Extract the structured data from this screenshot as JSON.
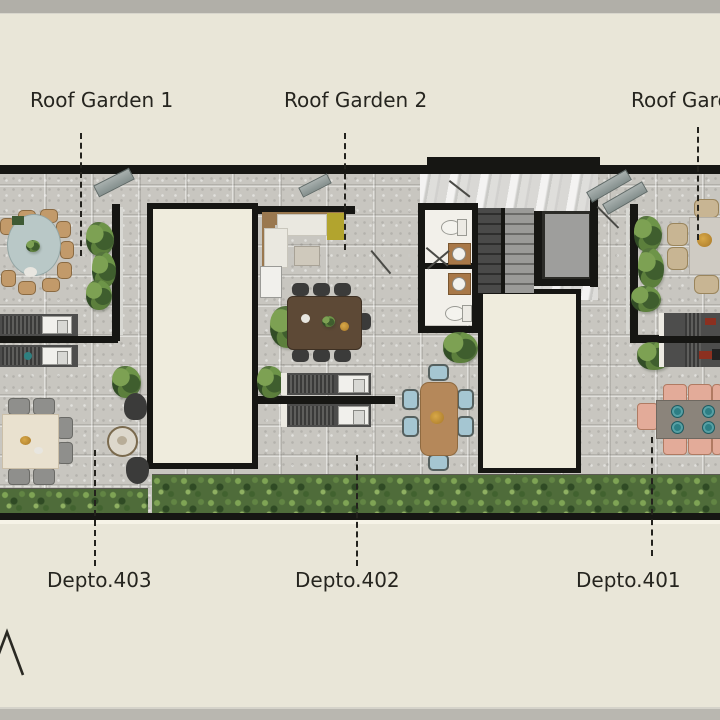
{
  "page": {
    "background_color": "#e9e6d8",
    "top_bar_color": "#b1afa8",
    "bottom_bar_color": "#b9b7b0"
  },
  "plan": {
    "roof_garden_labels": [
      {
        "label": "Roof Garden 1"
      },
      {
        "label": "Roof Garden 2"
      },
      {
        "label": "Roof Garden 3"
      }
    ],
    "department_labels": [
      {
        "label": "Depto.403"
      },
      {
        "label": "Depto.402"
      },
      {
        "label": "Depto.401"
      }
    ],
    "colors": {
      "wall": "#161613",
      "concrete_floor": "#c8c6c0",
      "room_fill": "#efecdd",
      "hedge_green": "#4f6c3a",
      "marble_core": "#d9d8d5",
      "label_text": "#26251f"
    }
  },
  "logo": {
    "icon": "mountain-peak-logo"
  }
}
